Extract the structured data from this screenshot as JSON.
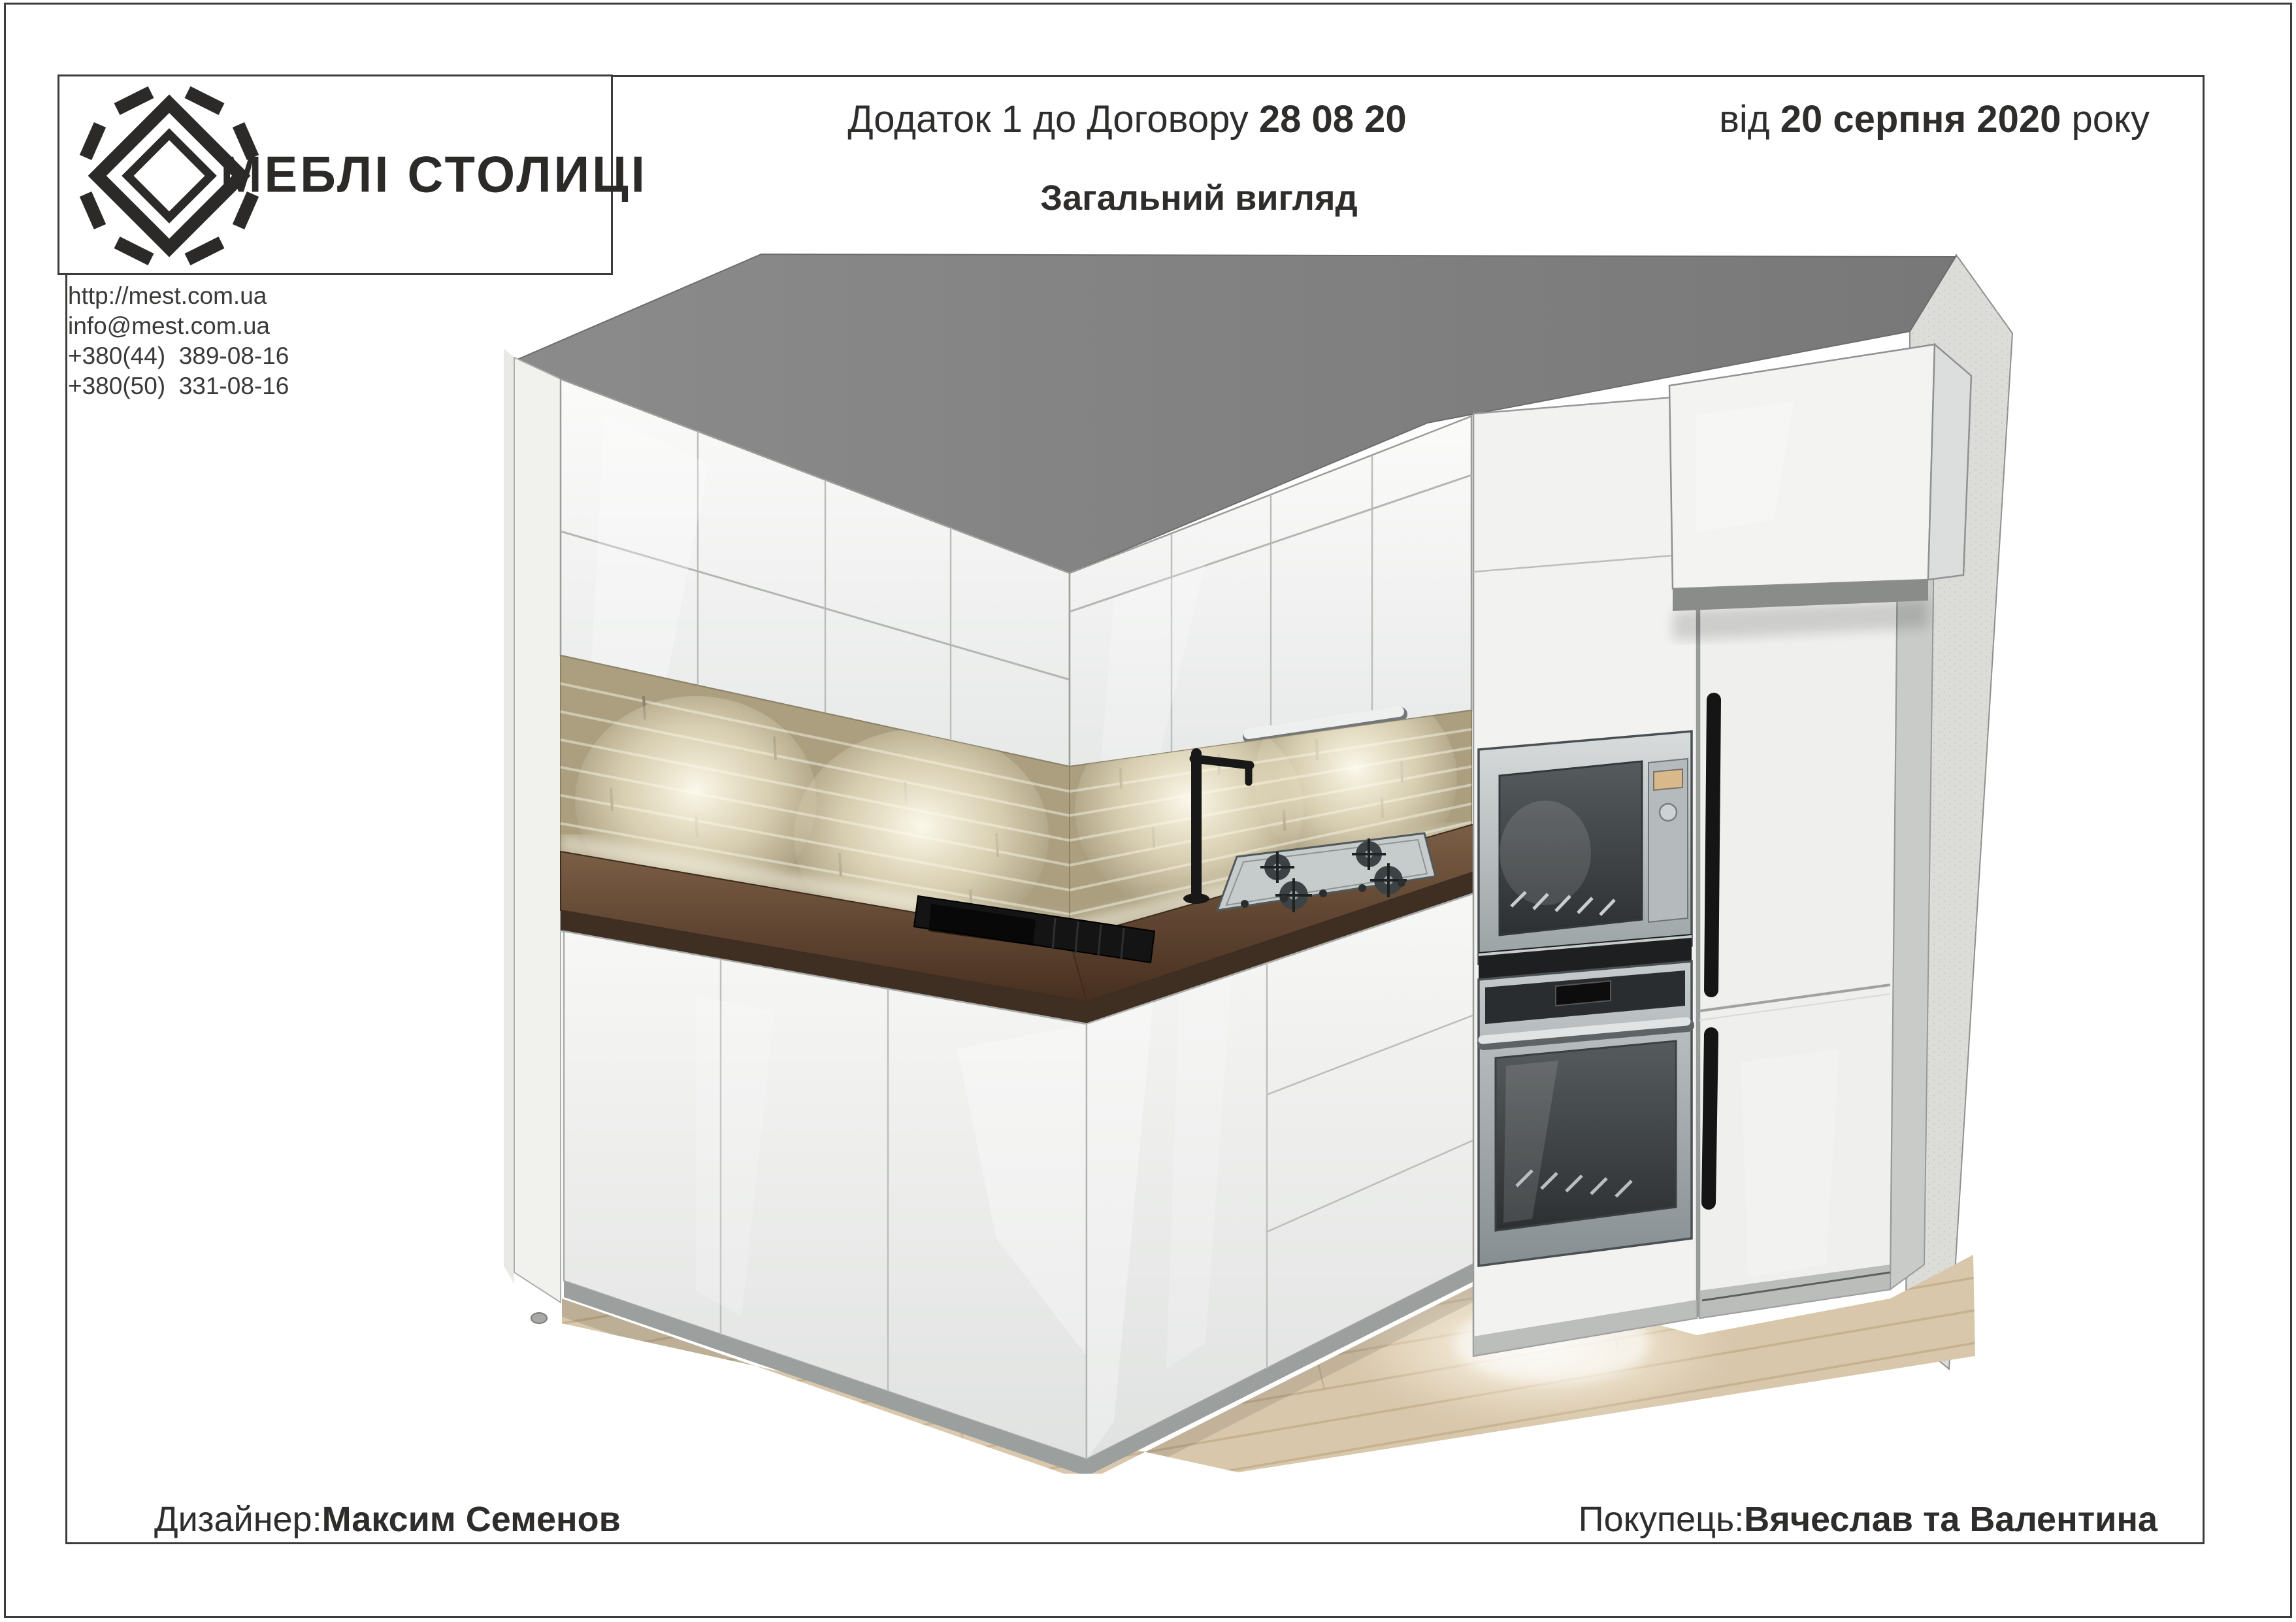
{
  "document": {
    "title_prefix": "Додаток 1 до Договору ",
    "contract_number": "28 08 20",
    "date_prefix": "від ",
    "date_value": "20 серпня 2020",
    "date_suffix": " року",
    "subtitle": "Загальний вигляд",
    "logo_text": "МЕБЛІ СТОЛИЦІ",
    "contacts": {
      "website": "http://mest.com.ua",
      "email": "info@mest.com.ua",
      "phone1": "+380(44)  389-08-16",
      "phone2": "+380(50)  331-08-16"
    },
    "footer": {
      "designer_label": "Дизайнер:",
      "designer_name": "Максим Семенов",
      "buyer_label": "Покупець:",
      "buyer_name": "Вячеслав та Валентина"
    }
  },
  "render": {
    "objects": [
      "ceiling",
      "left-wall-cabinets",
      "back-wall-cabinets",
      "brick-backsplash",
      "under-cabinet-light",
      "countertop",
      "sink",
      "faucet",
      "gas-hob",
      "tall-column",
      "microwave",
      "oven",
      "fridge",
      "above-fridge-cabinet",
      "base-cabinets",
      "plinth",
      "wood-floor",
      "right-wall"
    ]
  },
  "colors": {
    "text": "#2e2d2c",
    "frame": "#3b3b3a",
    "ceiling": "#808080",
    "cabinet_white": "#f3f3f1",
    "brick": "#ab9f80",
    "brick_light": "#f7f1de",
    "countertop": "#5d4533",
    "steel": "#c3c8c8",
    "fixture_black": "#1a1a1a",
    "floor_wood": "#d8c7ab"
  }
}
